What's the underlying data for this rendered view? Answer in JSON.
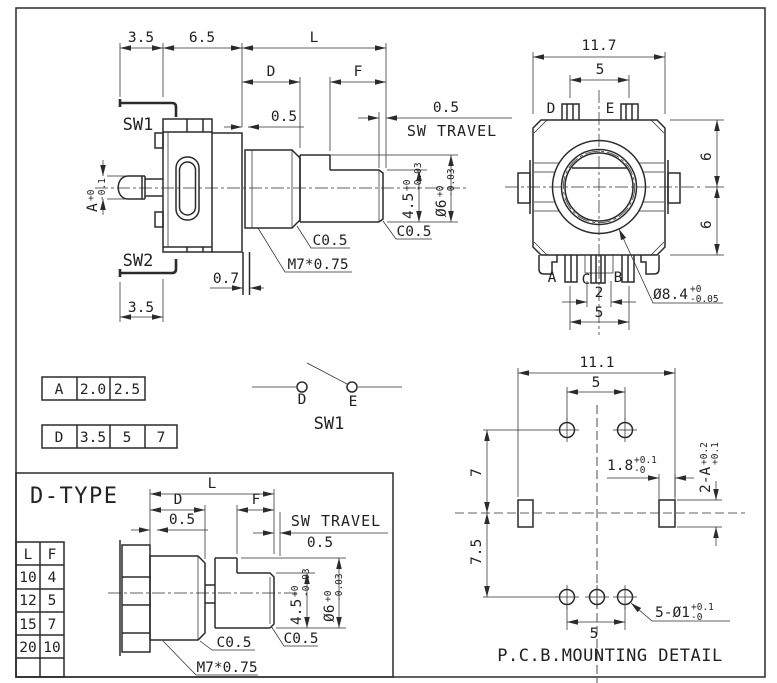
{
  "side_view": {
    "sw1_label": "SW1",
    "sw2_label": "SW2",
    "dim_3_5_top": "3.5",
    "dim_6_5": "6.5",
    "dim_L": "L",
    "dim_D": "D",
    "dim_F": "F",
    "dim_0_5_plate": "0.5",
    "sw_travel_value": "0.5",
    "sw_travel_label": "SW TRAVEL",
    "button_dim": {
      "value": "A",
      "tol_up": "+0",
      "tol_dn": "-0.1"
    },
    "flat_dim": {
      "value": "4.5",
      "tol_up": "+0",
      "tol_dn": "-0.03"
    },
    "shaft_dia": {
      "value": "Ø6",
      "tol_up": "+0",
      "tol_dn": "-0.03"
    },
    "chamfer_bushing": "C0.5",
    "chamfer_shaft": "C0.5",
    "thread_spec": "M7*0.75",
    "dim_0_7": "0.7",
    "dim_3_5_bottom": "3.5"
  },
  "front_view": {
    "dim_11_7": "11.7",
    "dim_5_top": "5",
    "pin_d": "D",
    "pin_e": "E",
    "dim_6_upper": "6",
    "dim_6_lower": "6",
    "pin_a": "A",
    "pin_c": "C",
    "pin_b": "B",
    "dim_2": "2",
    "dim_5_bottom": "5",
    "bushing_dia": {
      "value": "Ø8.4",
      "tol_up": "+0",
      "tol_dn": "-0.05"
    }
  },
  "param_tables": {
    "a_row": [
      "A",
      "2.0",
      "2.5"
    ],
    "d_row": [
      "D",
      "3.5",
      "5",
      "7"
    ]
  },
  "sw1_schematic": {
    "pin_d": "D",
    "pin_e": "E",
    "title": "SW1"
  },
  "d_type": {
    "title": "D-TYPE",
    "table": {
      "headers": [
        "L",
        "F"
      ],
      "rows": [
        [
          "10",
          "4"
        ],
        [
          "12",
          "5"
        ],
        [
          "15",
          "7"
        ],
        [
          "20",
          "10"
        ]
      ]
    },
    "dim_L": "L",
    "dim_D": "D",
    "dim_F": "F",
    "dim_0_5": "0.5",
    "sw_travel_label": "SW TRAVEL",
    "sw_travel_value": "0.5",
    "flat_dim": {
      "value": "4.5",
      "tol_up": "+0",
      "tol_dn": "-0.03"
    },
    "shaft_dia": {
      "value": "Ø6",
      "tol_up": "+0",
      "tol_dn": "-0.03"
    },
    "chamfer_bushing": "C0.5",
    "chamfer_shaft": "C0.5",
    "thread_spec": "M7*0.75"
  },
  "pcb_detail": {
    "dim_11_1": "11.1",
    "dim_5_top": "5",
    "dim_7": "7",
    "dim_7_5": "7.5",
    "slot_width": {
      "value": "1.8",
      "tol_up": "+0.1",
      "tol_dn": "-0"
    },
    "slot_height": {
      "value": "2-A",
      "tol_up": "+0.2",
      "tol_dn": "+0.1"
    },
    "dim_5_bottom": "5",
    "holes": {
      "value": "5-Ø1",
      "tol_up": "+0.1",
      "tol_dn": "-0"
    },
    "title": "P.C.B.MOUNTING DETAIL"
  }
}
